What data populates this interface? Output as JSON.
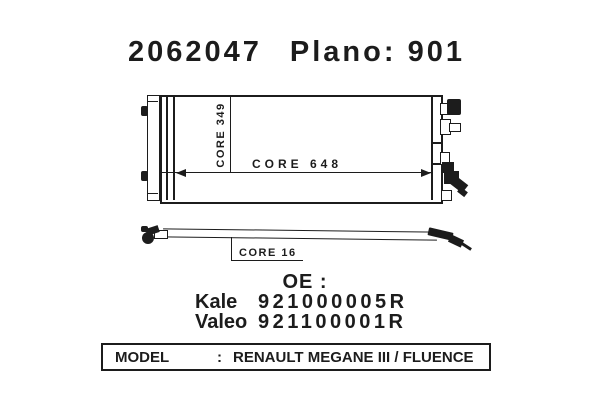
{
  "page": {
    "background": "#ffffff",
    "ink": "#1c1c1c"
  },
  "header": {
    "part_number": "2062047",
    "plano": "Plano: 901"
  },
  "front_view": {
    "core_height_label": "CORE 349",
    "core_width_label": "CORE 648"
  },
  "side_view": {
    "core_depth_label": "CORE 16"
  },
  "oe_section": {
    "heading": "OE :",
    "references": [
      {
        "brand": "Kale",
        "number": "921000005R"
      },
      {
        "brand": "Valeo",
        "number": "921100001R"
      }
    ]
  },
  "model_bar": {
    "label": "MODEL",
    "separator": ":",
    "value": "RENAULT MEGANE III / FLUENCE"
  }
}
